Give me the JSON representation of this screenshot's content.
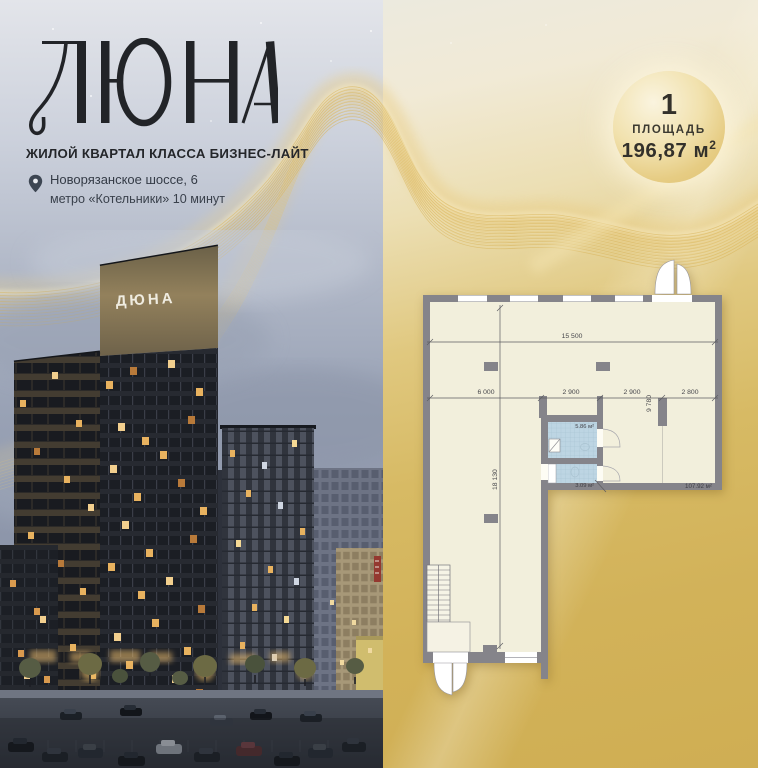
{
  "brand": {
    "logo_text": "ДЮНА",
    "tagline": "ЖИЛОЙ КВАРТАЛ КЛАССА БИЗНЕС-ЛАЙТ",
    "address": "Новорязанское шоссе, 6",
    "metro": "метро «Котельники» 10 минут"
  },
  "badge": {
    "number": "1",
    "label": "ПЛОЩАДЬ",
    "value": "196,87",
    "unit": "м",
    "sup": "2"
  },
  "building": {
    "sign_text": "ДЮНА"
  },
  "plan": {
    "dim_top": "15 500",
    "dim_left": "18 130",
    "dim_right_section": "9 780",
    "dim_segments": [
      "6 000",
      "2 900",
      "2 900",
      "2 800"
    ],
    "area_bath_large": "5.86 м²",
    "area_bath_small": "3.09 м²",
    "area_main": "107.92 м²"
  },
  "colors": {
    "gold_deep": "#d2b058",
    "gold_pale": "#f1ead6",
    "text_dark": "#26272b",
    "plan_wall": "#85848a",
    "plan_floor": "#f2efdc",
    "plan_tile": "#bdd5e3"
  }
}
